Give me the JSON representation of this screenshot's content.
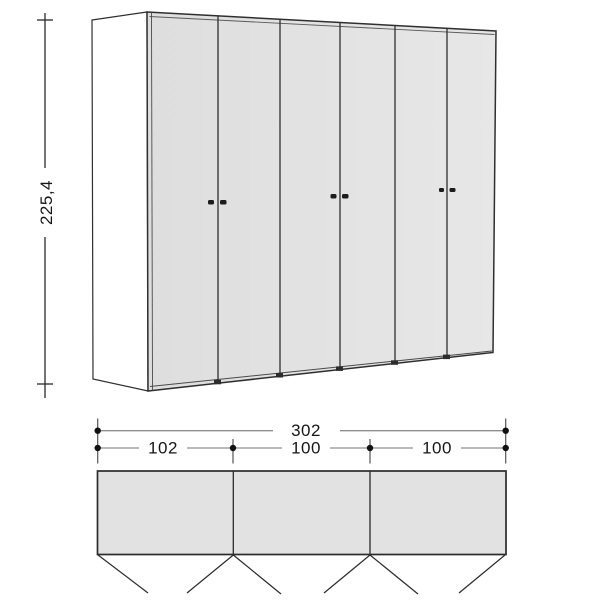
{
  "diagram": {
    "front_view": {
      "height_dimension": {
        "label": "225,4"
      },
      "door_count": 6,
      "handle_pairs": 3
    },
    "plan_view": {
      "overall_width": {
        "label": "302"
      },
      "sections": [
        {
          "label": "102"
        },
        {
          "label": "100"
        },
        {
          "label": "100"
        }
      ],
      "compartment_count": 3,
      "door_swing_count": 6
    },
    "colors": {
      "door_fill": "#e2e2e2",
      "side_panel_fill": "#ffffff",
      "outline": "#2f2f2f",
      "dimension_line": "#8f8f8f",
      "dimension_tick": "#555555",
      "dimension_dot": "#111111",
      "text": "#161616",
      "background": "#ffffff"
    }
  }
}
